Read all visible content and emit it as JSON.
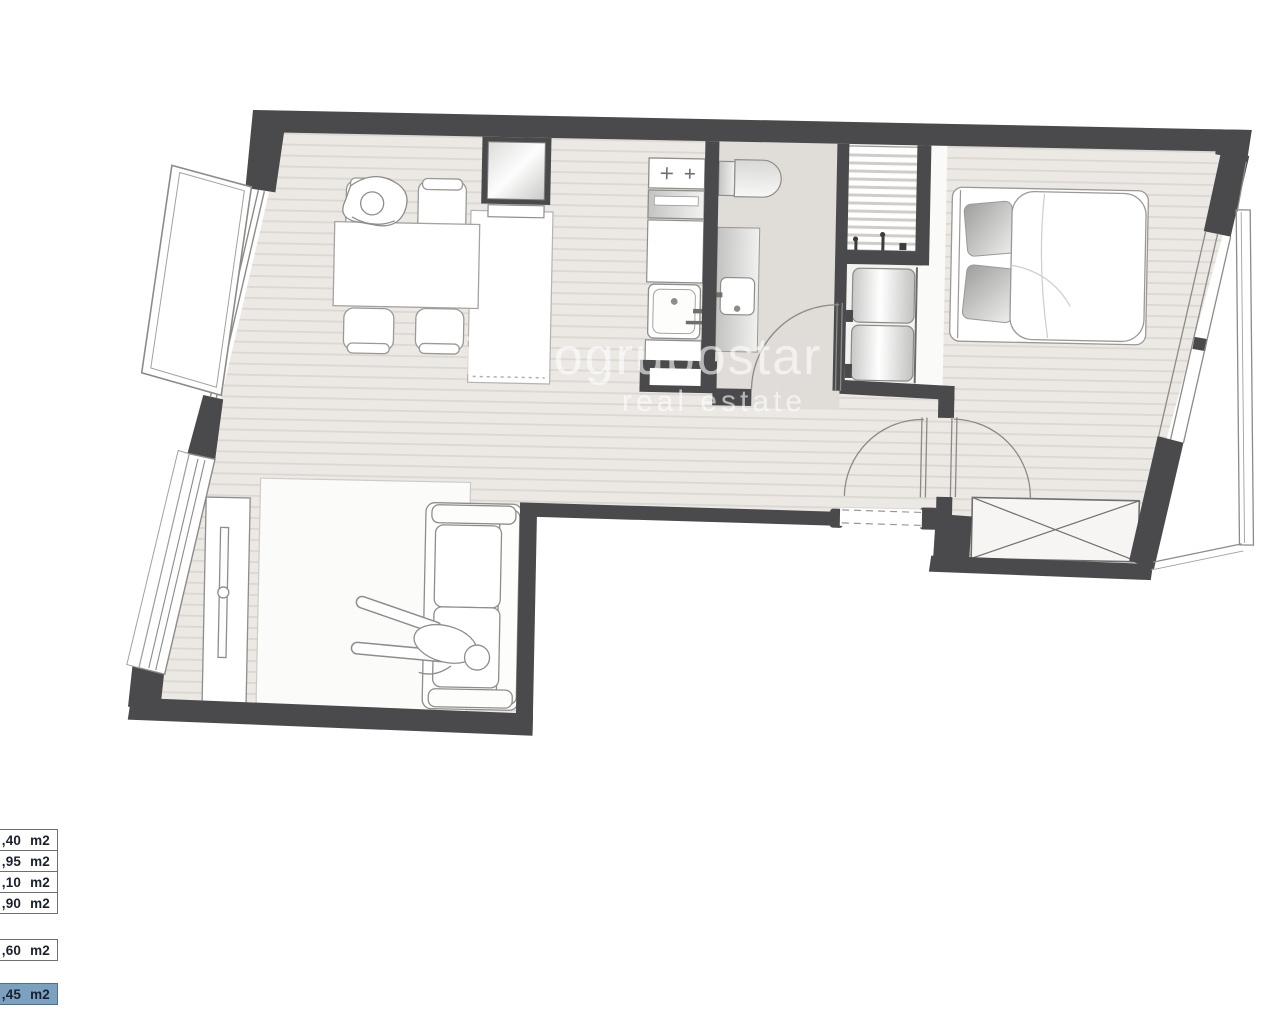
{
  "watermark": {
    "brand": "inmogrupostar",
    "tagline": "real estate",
    "color": "#ffffff",
    "opacity": "0.6"
  },
  "legend": {
    "items": [
      {
        "label": ",40 m2",
        "highlighted": false
      },
      {
        "label": ",95 m2",
        "highlighted": false
      },
      {
        "label": ",10 m2",
        "highlighted": false
      },
      {
        "label": ",90 m2",
        "highlighted": false
      },
      {
        "label": ",60 m2",
        "highlighted": false
      },
      {
        "label": ",45 m2",
        "highlighted": true
      }
    ],
    "highlight_color": "#7ba0c0",
    "text_color": "#1a202c"
  },
  "plan": {
    "type": "apartment-floor-plan",
    "colors": {
      "wall": "#4a4a4c",
      "floor_background": "#ece9e5",
      "floor_stripe": "#dbd7d2",
      "tile_floor": "#e0dcd7",
      "furniture_outline": "#8f8d8a"
    },
    "rooms": [
      "living-dining",
      "kitchen",
      "bathroom",
      "utility",
      "entrance-hall",
      "bedroom",
      "lounge"
    ],
    "furniture": [
      "dining-table",
      "dining-chairs",
      "person-at-table",
      "fridge",
      "cooktop",
      "oven",
      "kitchen-sink",
      "toilet",
      "washbasin-vanity",
      "shelving-grille",
      "washer-dryer-stack",
      "double-bed",
      "pillows",
      "built-in-wardrobe",
      "sofa",
      "person-on-sofa",
      "tv-sideboard",
      "rug",
      "balcony-window-leaf",
      "side-windows",
      "swing-doors"
    ]
  }
}
